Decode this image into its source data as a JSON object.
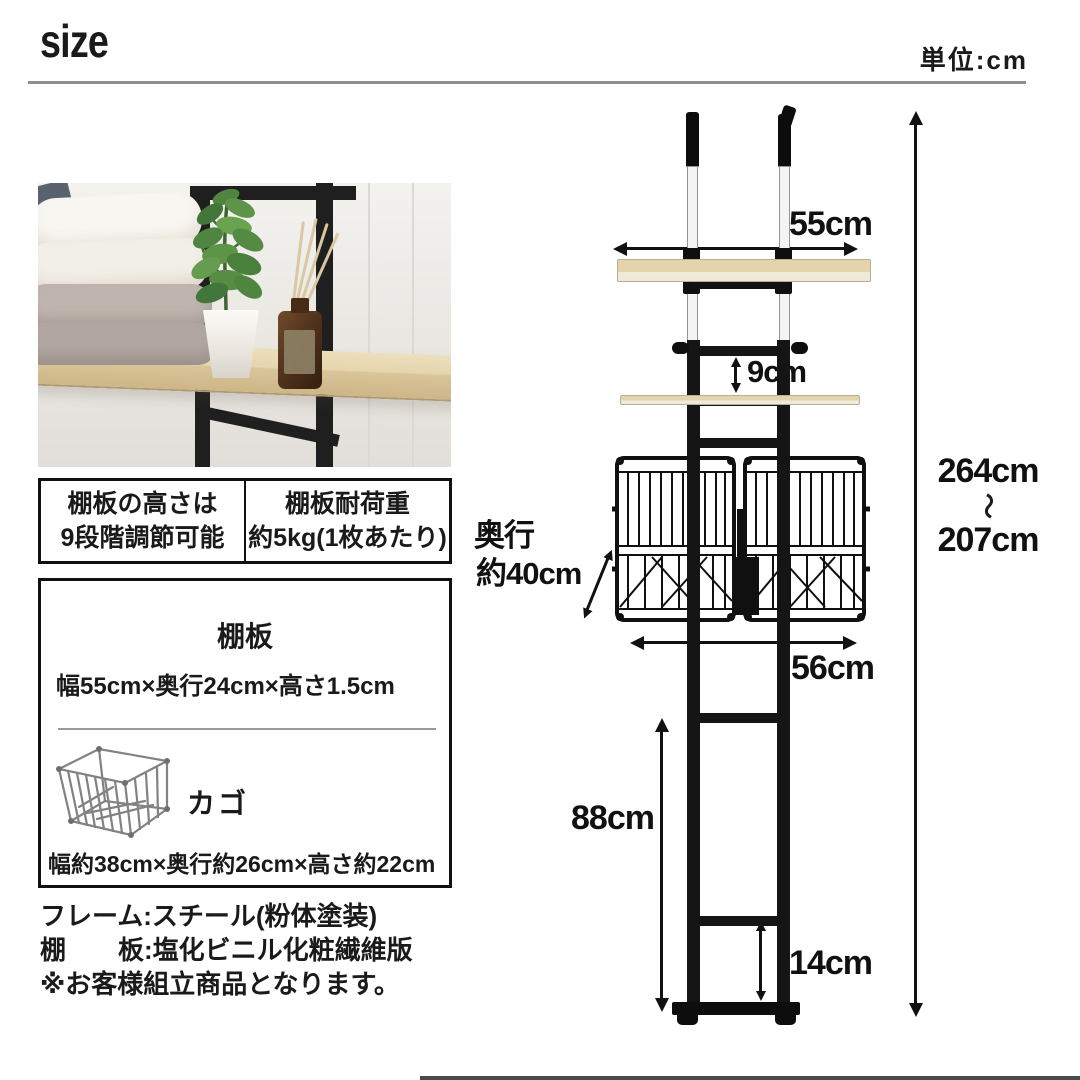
{
  "header": {
    "title": "size",
    "unit": "単位:cm"
  },
  "highlights": {
    "left": {
      "line1": "棚板の高さは",
      "line2": "9段階調節可能"
    },
    "right": {
      "line1": "棚板耐荷重",
      "line2": "約5kg(1枚あたり)"
    }
  },
  "spec_box": {
    "shelf_title": "棚板",
    "shelf_size": "幅55cm×奥行24cm×高さ1.5cm",
    "basket_title": "カゴ",
    "basket_size": "幅約38cm×奥行約26cm×高さ約22cm"
  },
  "materials": {
    "frame": "フレーム:スチール(粉体塗装)",
    "board": "棚　　板:塩化ビニル化粧繊維版",
    "note": "※お客様組立商品となります。"
  },
  "dimensions": {
    "top_shelf_width": "55cm",
    "shelf_pitch": "9cm",
    "depth_label": "奥行",
    "depth_value": "約40cm",
    "basket_section_width": "56cm",
    "lower_section_height": "88cm",
    "bottom_rung_height": "14cm",
    "overall_height_max": "264cm",
    "range_tilde": "〜",
    "overall_height_min": "207cm"
  },
  "colors": {
    "ink": "#1a1a1a",
    "rule_gray": "#8f8f8f",
    "wood": "#e4d4ab",
    "wood_edge": "#f0ead9",
    "pole_silver": "#f4f4f4",
    "frame_black": "#151515"
  }
}
